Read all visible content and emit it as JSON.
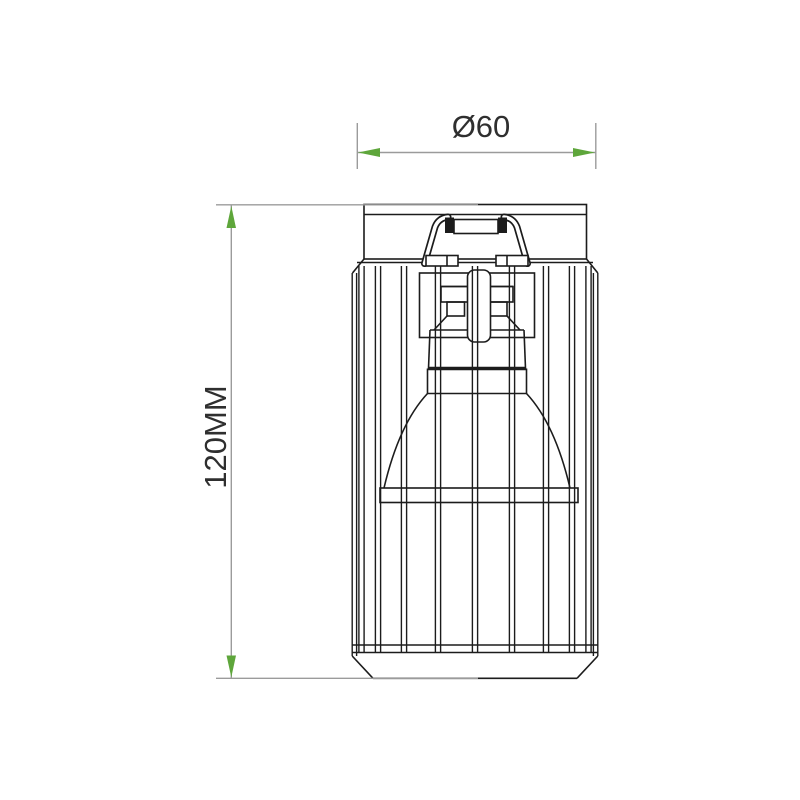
{
  "title": "Cage spotlight fixture dimension drawing",
  "drawing": {
    "dimension_width": {
      "label": "Ø60"
    },
    "dimension_height": {
      "label": "120MM"
    }
  },
  "colors": {
    "outline": "#1c1c1c",
    "dimension_line": "#9b9b9b",
    "arrow_green": "#5ea63b",
    "label_text": "#2f2f2f",
    "background": "#ffffff"
  }
}
